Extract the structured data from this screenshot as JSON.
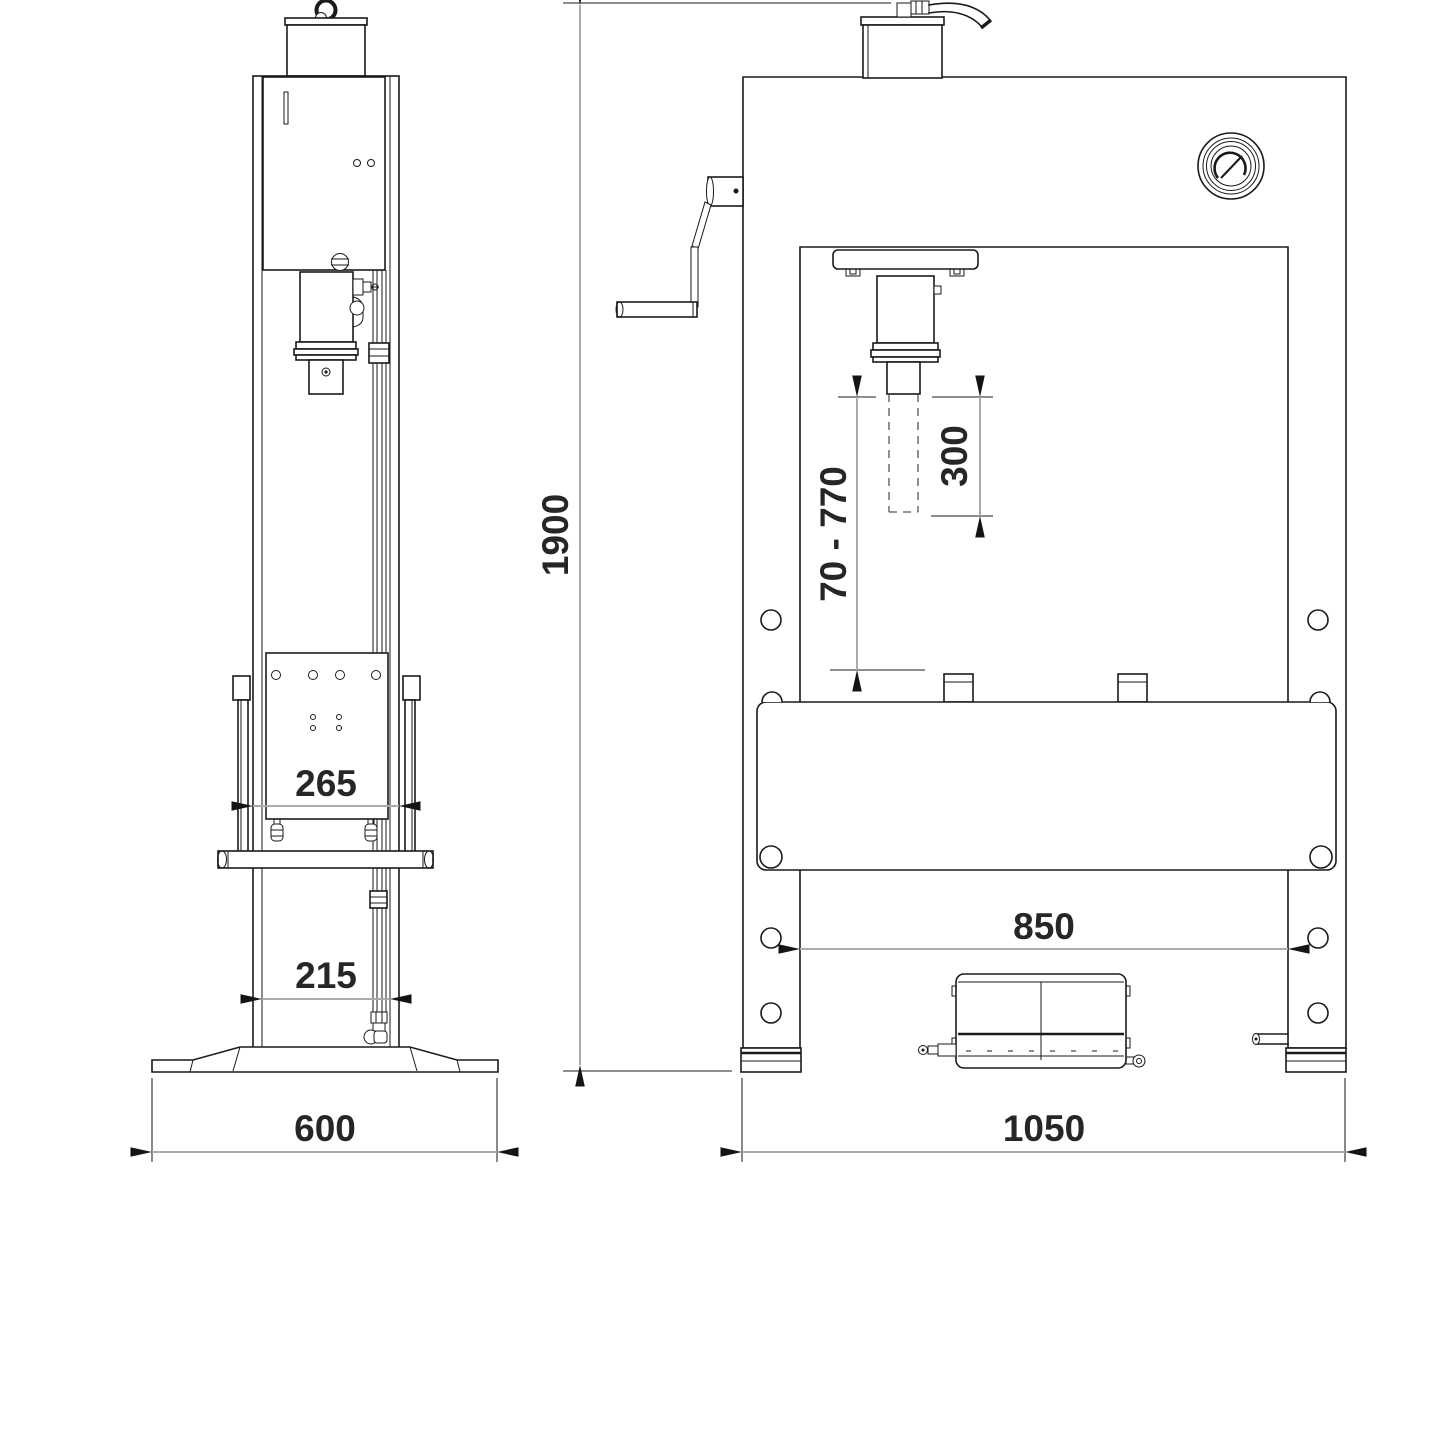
{
  "drawing": {
    "background": "#ffffff",
    "line_color": "#1a1a1a",
    "dimension_line_color": "#ababab",
    "text_color": "#262626",
    "side_view": {
      "dim_table_width": "265",
      "dim_column_spacing": "215",
      "dim_base_width": "600"
    },
    "front_view": {
      "dim_overall_height": "1900",
      "dim_working_range": "70 - 770",
      "dim_stroke": "300",
      "dim_inner_width": "850",
      "dim_overall_width": "1050"
    }
  }
}
